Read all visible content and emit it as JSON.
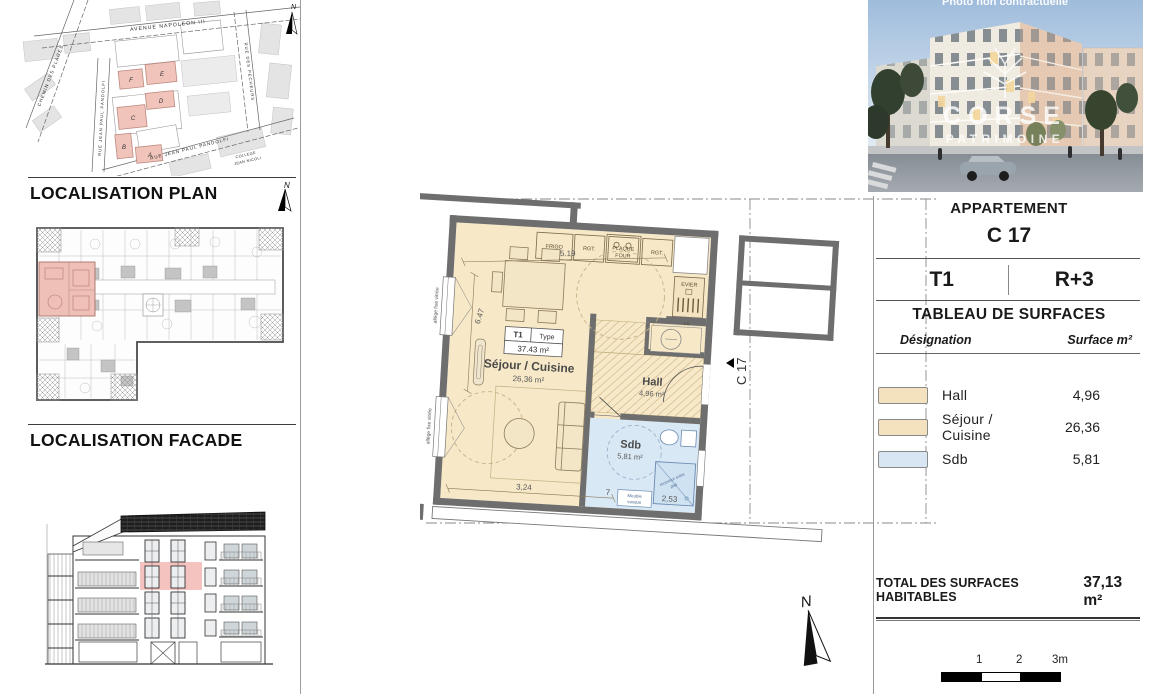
{
  "left": {
    "plan_heading": "LOCALISATION PLAN",
    "facade_heading": "LOCALISATION FACADE",
    "north_letter": "N",
    "map": {
      "streets": {
        "avenue": "AVENUE NAPOLEON III",
        "chemin": "CHEMIN DES PLAGES",
        "rue_pandolfi_v": "RUE JEAN PAUL PANDOLFI",
        "rue_pandolfi_b": "RUE JEAN PAUL PANDOLFI",
        "rue_pecheurs": "RUE DES PECHEURS",
        "college_l1": "COLLEGE",
        "college_l2": "JEAN NICOLI"
      },
      "blocks": {
        "a": "A",
        "b": "B",
        "c": "C",
        "d": "D",
        "e": "E",
        "f": "F"
      }
    }
  },
  "plan": {
    "unit_tag": "C 17",
    "type_box": {
      "t1": "T1",
      "type": "Type",
      "area": "37.43 m²"
    },
    "rooms": {
      "sejour": {
        "name": "Séjour / Cuisine",
        "area": "26,36 m²"
      },
      "hall": {
        "name": "Hall",
        "area": "4,96 m²"
      },
      "sdb": {
        "name": "Sdb",
        "area": "5,81 m²"
      }
    },
    "kitchen": {
      "frigo": "FRIGO",
      "rgt1": "RGT.",
      "plaque_l1": "PLAQUE",
      "plaque_l2": "FOUR",
      "rgt2": "RGT.",
      "evier": "EVIER",
      "lv": "LV"
    },
    "labels": {
      "allege": "allège fixe vitrée",
      "meuble_l1": "Meuble",
      "meuble_l2": "vasque",
      "receveur_l1": "receveur extra",
      "receveur_l2": "plat"
    },
    "dims": {
      "top": "5.19",
      "left": "6.47",
      "b1": "3,24",
      "b2": "7",
      "b3": "2,53"
    },
    "north_letter": "N"
  },
  "photo": {
    "caption": "Photo non contractuelle",
    "watermark_l1": "CORSE",
    "watermark_l2": "PATRIMOINE"
  },
  "panel": {
    "heading": "APPARTEMENT",
    "unit": "C 17",
    "type": "T1",
    "floor": "R+3",
    "table_title": "TABLEAU DE SURFACES",
    "col_left": "Désignation",
    "col_right": "Surface m²",
    "rows": [
      {
        "label": "Hall",
        "value": "4,96",
        "color": "#f3e2bd"
      },
      {
        "label": "Séjour / Cuisine",
        "value": "26,36",
        "color": "#f3e2bd"
      },
      {
        "label": "Sdb",
        "value": "5,81",
        "color": "#d8e6f4"
      }
    ],
    "total_label": "TOTAL DES SURFACES HABITABLES",
    "total_value": "37,13 m²",
    "scale": {
      "l1": "1",
      "l2": "2",
      "l3": "3m"
    }
  },
  "colors": {
    "floor_beige": "#f7e8c8",
    "hatch_beige": "#c6ad7e",
    "sdb_blue": "#d9e8f5",
    "wall_gray": "#6e6e6e",
    "highlight_pink": "#f2c4bc"
  }
}
